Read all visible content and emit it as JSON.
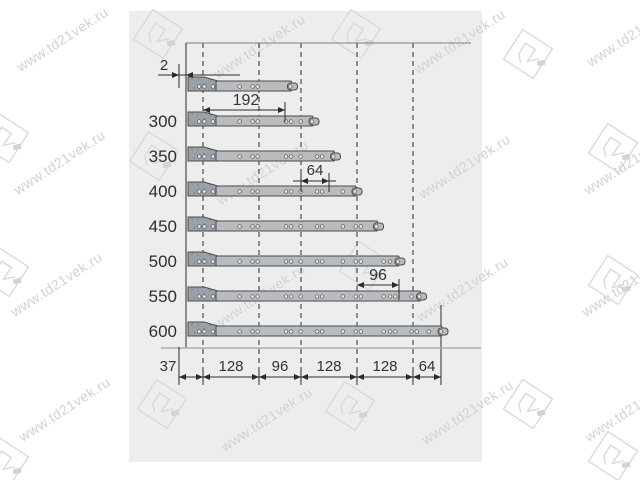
{
  "watermark": {
    "url": "www.td21vek.ru",
    "logo": "21"
  },
  "colors": {
    "panel": "#ededed",
    "rail_fill": "#b9bcbf",
    "bracket_fill": "#9aa1a8",
    "line": "#2b2b2b",
    "boundary_top": "#808080",
    "boundary_bottom": "#aeaeae",
    "watermark_text": "#d2d2d2",
    "watermark_logo": "#d9d9d9",
    "dim_text": "#333333"
  },
  "diagram": {
    "dims": {
      "offset": "2",
      "top": "192",
      "middle": "64",
      "lower": "96"
    },
    "rails": [
      {
        "label": "",
        "length_mm": 250
      },
      {
        "label": "300",
        "length_mm": 300
      },
      {
        "label": "350",
        "length_mm": 350
      },
      {
        "label": "400",
        "length_mm": 400
      },
      {
        "label": "450",
        "length_mm": 450
      },
      {
        "label": "500",
        "length_mm": 500
      },
      {
        "label": "550",
        "length_mm": 550
      },
      {
        "label": "600",
        "length_mm": 600
      }
    ],
    "bottom_dims": [
      {
        "label": "37",
        "mm": 37
      },
      {
        "label": "128",
        "mm": 128
      },
      {
        "label": "96",
        "mm": 96
      },
      {
        "label": "128",
        "mm": 128
      },
      {
        "label": "128",
        "mm": 128
      },
      {
        "label": "64",
        "mm": 64
      }
    ]
  }
}
